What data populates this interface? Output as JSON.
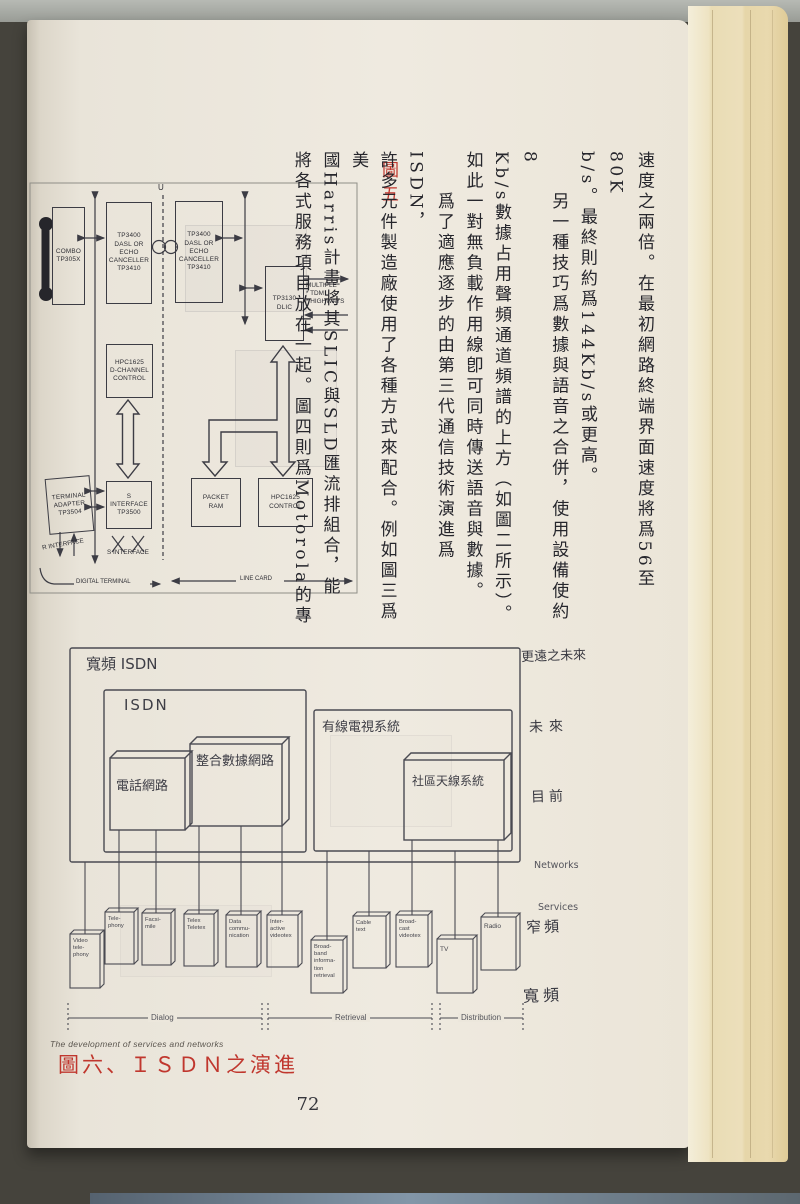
{
  "page": {
    "number": "72",
    "caption_en": "The development of services and networks",
    "caption_red": "圖六、ＩＳＤＮ之演進",
    "fig5_red_label": "圖五"
  },
  "colors": {
    "caption_red": "#c0372e",
    "diagram_ink": "#3c3c44",
    "page_background": "#ece7dc",
    "fore_edge": "#ecdfbb"
  },
  "paragraph": {
    "columns": [
      {
        "text": "速度之兩倍。在最初網路終端界面速度將爲56至80K",
        "indent": false
      },
      {
        "text": "b/s。最終則約爲144Kb/s或更高。",
        "indent": false
      },
      {
        "text": "另一種技巧爲數據與語音之合併，使用設備使約8",
        "indent": true
      },
      {
        "text": "Kb/s數據占用聲頻通道頻譜的上方（如圖二所示）。",
        "indent": false
      },
      {
        "text": "如此一對無負載作用線卽可同時傳送語音與數據。",
        "indent": false
      },
      {
        "text": "爲了適應逐步的由第三代通信技術演進爲ISDN，",
        "indent": true
      },
      {
        "text": "許多元件製造廠使用了各種方式來配合。例如圖三爲美",
        "indent": false
      },
      {
        "text": "國Harris計畫將其SLIC與SLD匯流排組合，能",
        "indent": false
      },
      {
        "text": "將各式服務項目放在一起。圖四則爲Motorola的專",
        "indent": false
      }
    ]
  },
  "fig5": {
    "boxes": {
      "combo": "COMBO\nTP305X",
      "dasl_left": "TP3400\nDASL OR\nECHO\nCANCELLER\nTP3410",
      "dasl_right": "TP3400\nDASL OR\nECHO\nCANCELLER\nTP3410",
      "dlic": "TP3130\nDLIC",
      "d_channel": "HPC1625\nD-CHANNEL\nCONTROL",
      "s_interface": "S INTERFACE\nTP3500",
      "terminal_adapter": "TERMINAL\nADAPTER\nTP3504",
      "packet_ram": "PACKET\nRAM",
      "hpc_control": "HPC1625\nCONTROL"
    },
    "labels": {
      "u": "U",
      "tdm": "MULTIPLE\n* TDM\n* HIGHWAYS",
      "r_interface": "R INTERFACE",
      "s_interface": "S INTERFACE",
      "digital_terminal": "DIGITAL TERMINAL",
      "line_card": "LINE CARD"
    }
  },
  "fig6": {
    "boxes": {
      "broadband_isdn": "寬頻 ISDN",
      "isdn": "ISDN",
      "telephone_network": "電話網路",
      "integrated_data_network": "整合數據網路",
      "cable_tv_system": "有線電視系統",
      "community_antenna_system": "社區天線系統"
    },
    "services": [
      "Video\ntele-\nphony",
      "Tele-\nphony",
      "Facsi-\nmile",
      "Telex\nTeletex",
      "Data\ncommu-\nnication",
      "Inter-\nactive\nvideotex",
      "Broad-\nband\ninforma-\ntion\nretrieval",
      "Cable\ntext",
      "Broad-\ncast\nvideotex",
      "TV",
      "Radio"
    ],
    "brackets": {
      "dialog": "Dialog",
      "retrieval": "Retrieval",
      "distribution": "Distribution"
    },
    "margin": {
      "far_future": "更遠之未來",
      "future": "未來",
      "present": "目前",
      "networks": "Networks",
      "services": "Services",
      "narrowband": "窄頻",
      "broadband": "寬頻"
    }
  }
}
